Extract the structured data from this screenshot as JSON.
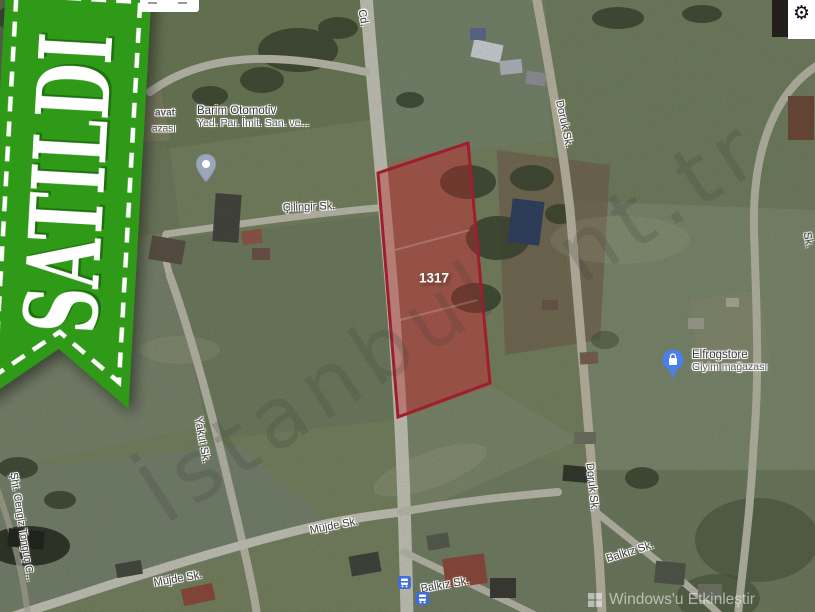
{
  "sold_banner": {
    "text": "SATILDI",
    "ribbon_color": "#2f9a17",
    "text_color": "#ffffff"
  },
  "map_controls": {
    "gear_icon": "⚙"
  },
  "parcel": {
    "number": "1317",
    "border_color": "#9e1f2c",
    "fill_color": "rgba(185,40,40,0.38)"
  },
  "street_labels": [
    {
      "id": "cd-partial",
      "text": "Cd."
    },
    {
      "id": "cilingir",
      "text": "Çilingir Sk."
    },
    {
      "id": "doruk-upper",
      "text": "Doruk Sk."
    },
    {
      "id": "doruk-lower",
      "text": "Doruk Sk."
    },
    {
      "id": "yakut",
      "text": "Yakut Sk."
    },
    {
      "id": "sht-cengiz",
      "text": "Şht. Cengiz Tonguç C..."
    },
    {
      "id": "mujde-right",
      "text": "Müjde Sk."
    },
    {
      "id": "mujde-left",
      "text": "Müjde Sk."
    },
    {
      "id": "balkiz-center",
      "text": "Balkız Sk."
    },
    {
      "id": "balkiz-right",
      "text": "Balkız Sk."
    },
    {
      "id": "edge-fragment",
      "text": "Sk."
    }
  ],
  "places": [
    {
      "name": "Barim Otomotiv",
      "detail": "Yed. Par. İmlt. San. ve...",
      "pin": "gray-teardrop-pin"
    },
    {
      "name": "Elfrogstore",
      "detail": "Giyim mağazası",
      "pin": "blue-shopping-pin"
    }
  ],
  "partial_place_label": {
    "line1": "avat",
    "line2": "azası"
  },
  "watermark": {
    "fragment1": "İstanbul",
    "fragment2": "nt.tr"
  },
  "system_overlay": {
    "text": "Windows'u Etkinleştir"
  },
  "colors": {
    "transit_blue": "#3f6ed8",
    "pin_blue": "#4a80e8",
    "pin_gray": "#9aa7b8",
    "road": "#c2c1b4",
    "field_green": "#74805f",
    "tree_green": "#3a4531"
  }
}
